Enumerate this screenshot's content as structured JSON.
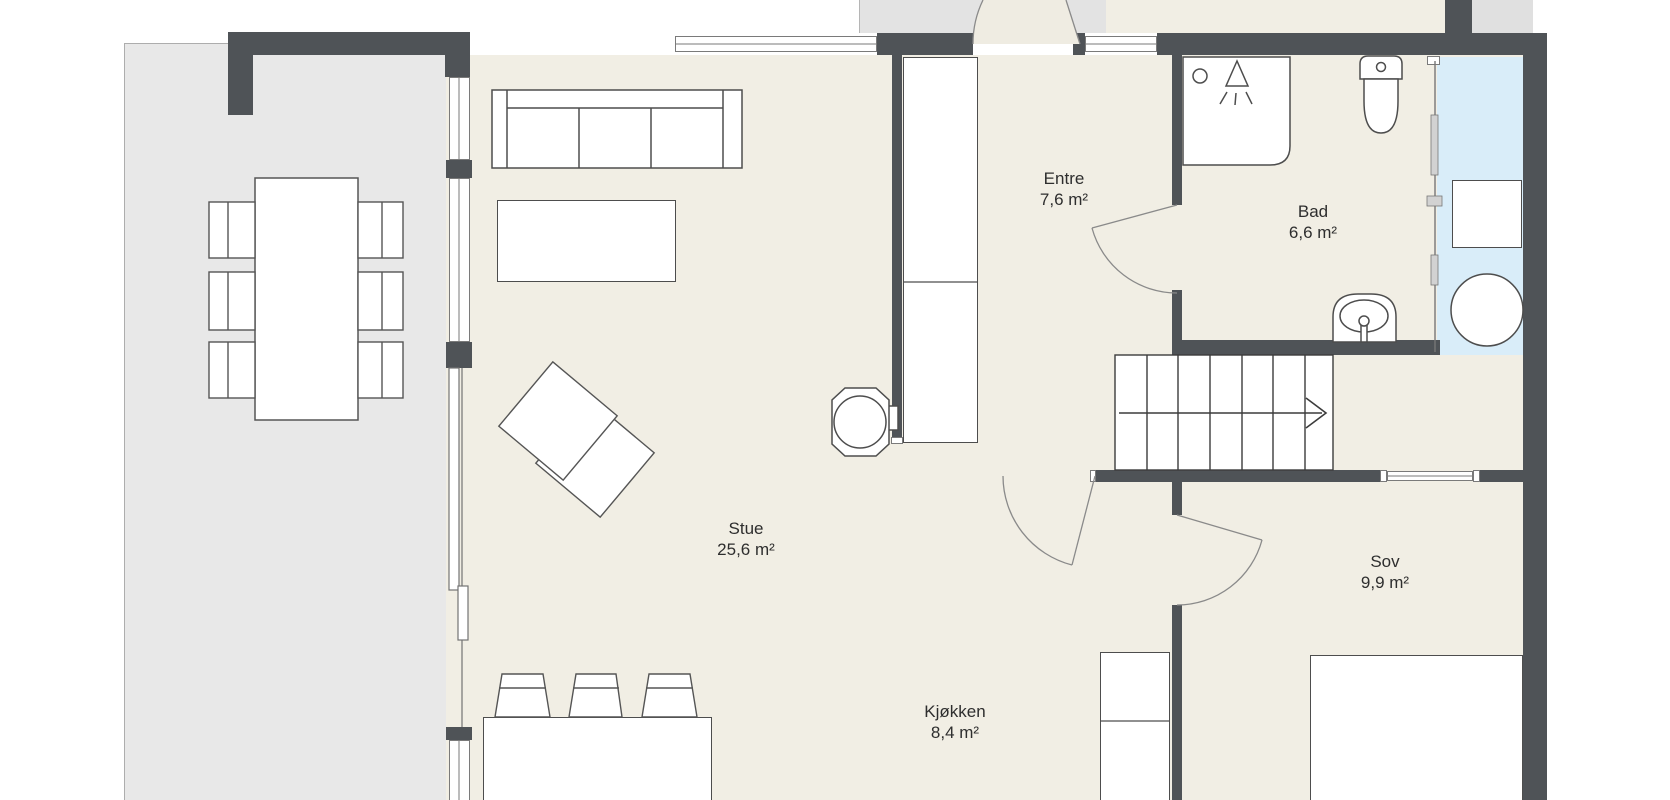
{
  "plan": {
    "type": "floor-plan",
    "rooms": [
      {
        "id": "stue",
        "name": "Stue",
        "area": "25,6 m²"
      },
      {
        "id": "entre",
        "name": "Entre",
        "area": "7,6 m²"
      },
      {
        "id": "bad",
        "name": "Bad",
        "area": "6,6 m²"
      },
      {
        "id": "sov",
        "name": "Sov",
        "area": "9,9 m²"
      },
      {
        "id": "kjokken",
        "name": "Kjøkken",
        "area": "8,4 m²"
      }
    ],
    "icons": [
      "sofa-icon",
      "coffee-table-icon",
      "lounge-chair-icon",
      "wood-stove-icon",
      "dining-table-icon",
      "dining-chair-icon",
      "bar-stool-icon",
      "kitchen-island-icon",
      "tall-cabinet-icon",
      "fridge-cabinet-icon",
      "bed-icon",
      "stairs-up-arrow-icon",
      "shower-icon",
      "toilet-icon",
      "washbasin-icon",
      "washing-machine-icon",
      "door-swing-icon",
      "sliding-door-icon",
      "window-icon"
    ],
    "colors": {
      "wall": "#4f5357",
      "floor": "#f1eee4",
      "terrace": "#e8e8e8",
      "wet_zone": "#d9edf9",
      "furniture_outline": "#4d4d4d",
      "background": "#ffffff"
    }
  }
}
